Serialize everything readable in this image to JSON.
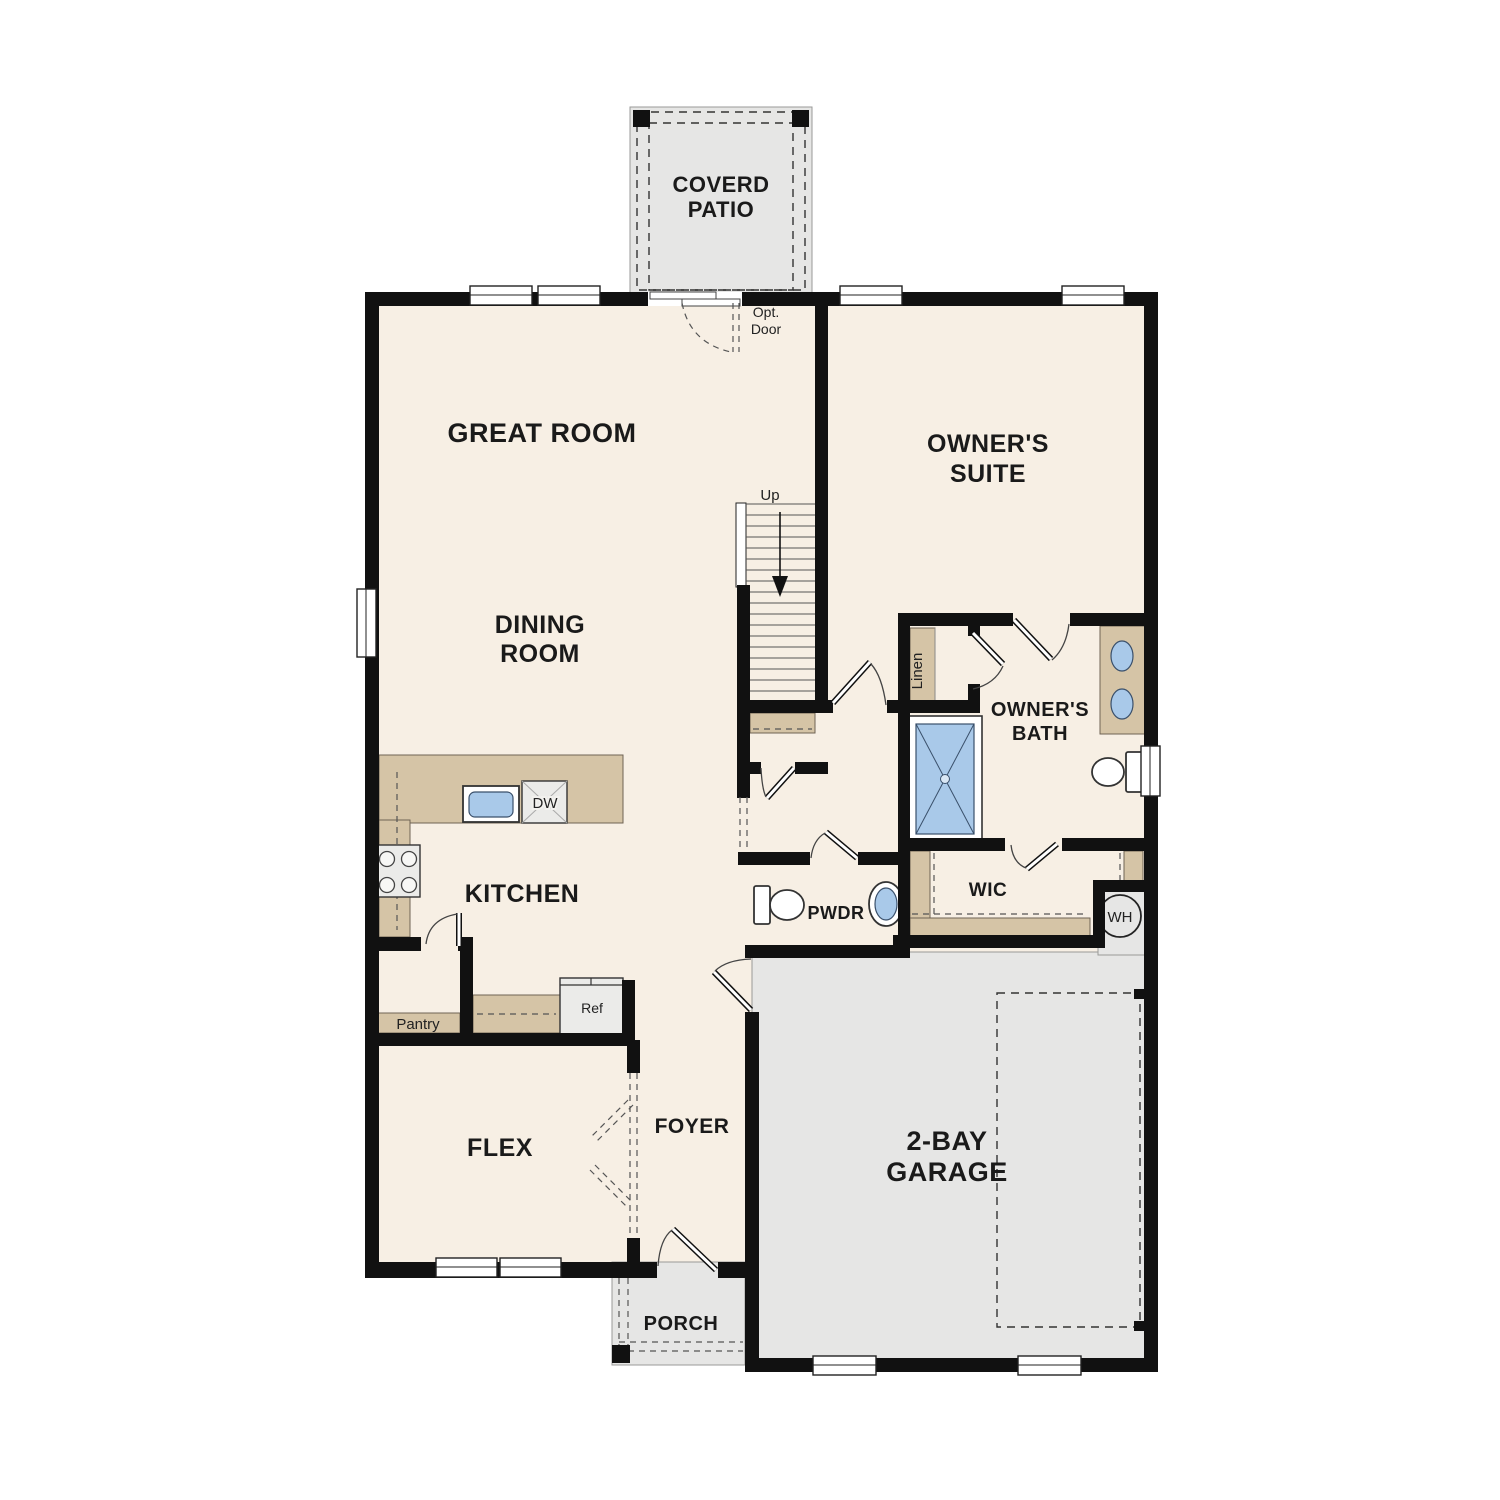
{
  "plan": {
    "type": "floor-plan",
    "rooms": {
      "covered_patio": {
        "line1": "COVERD",
        "line2": "PATIO"
      },
      "great_room": {
        "label": "GREAT ROOM"
      },
      "dining_room": {
        "line1": "DINING",
        "line2": "ROOM"
      },
      "owners_suite": {
        "line1": "OWNER'S",
        "line2": "SUITE"
      },
      "owners_bath": {
        "line1": "OWNER'S",
        "line2": "BATH"
      },
      "kitchen": {
        "label": "KITCHEN"
      },
      "flex": {
        "label": "FLEX"
      },
      "foyer": {
        "label": "FOYER"
      },
      "garage": {
        "line1": "2-BAY",
        "line2": "GARAGE"
      },
      "porch": {
        "label": "PORCH"
      },
      "powder_room": {
        "label": "PWDR"
      },
      "walk_in_closet": {
        "label": "WIC"
      }
    },
    "annotations": {
      "stairs_up": "Up",
      "opt_door_line1": "Opt.",
      "opt_door_line2": "Door",
      "linen_closet": "Linen",
      "pantry": "Pantry",
      "refrigerator": "Ref",
      "dishwasher": "DW",
      "water_heater": "WH"
    },
    "colors": {
      "floor": "#f7efe4",
      "wall": "#111111",
      "casework": "#d5c4a6",
      "concrete": "#e6e6e5",
      "fixture_blue": "#a9c9e9",
      "background": "#ffffff"
    }
  }
}
